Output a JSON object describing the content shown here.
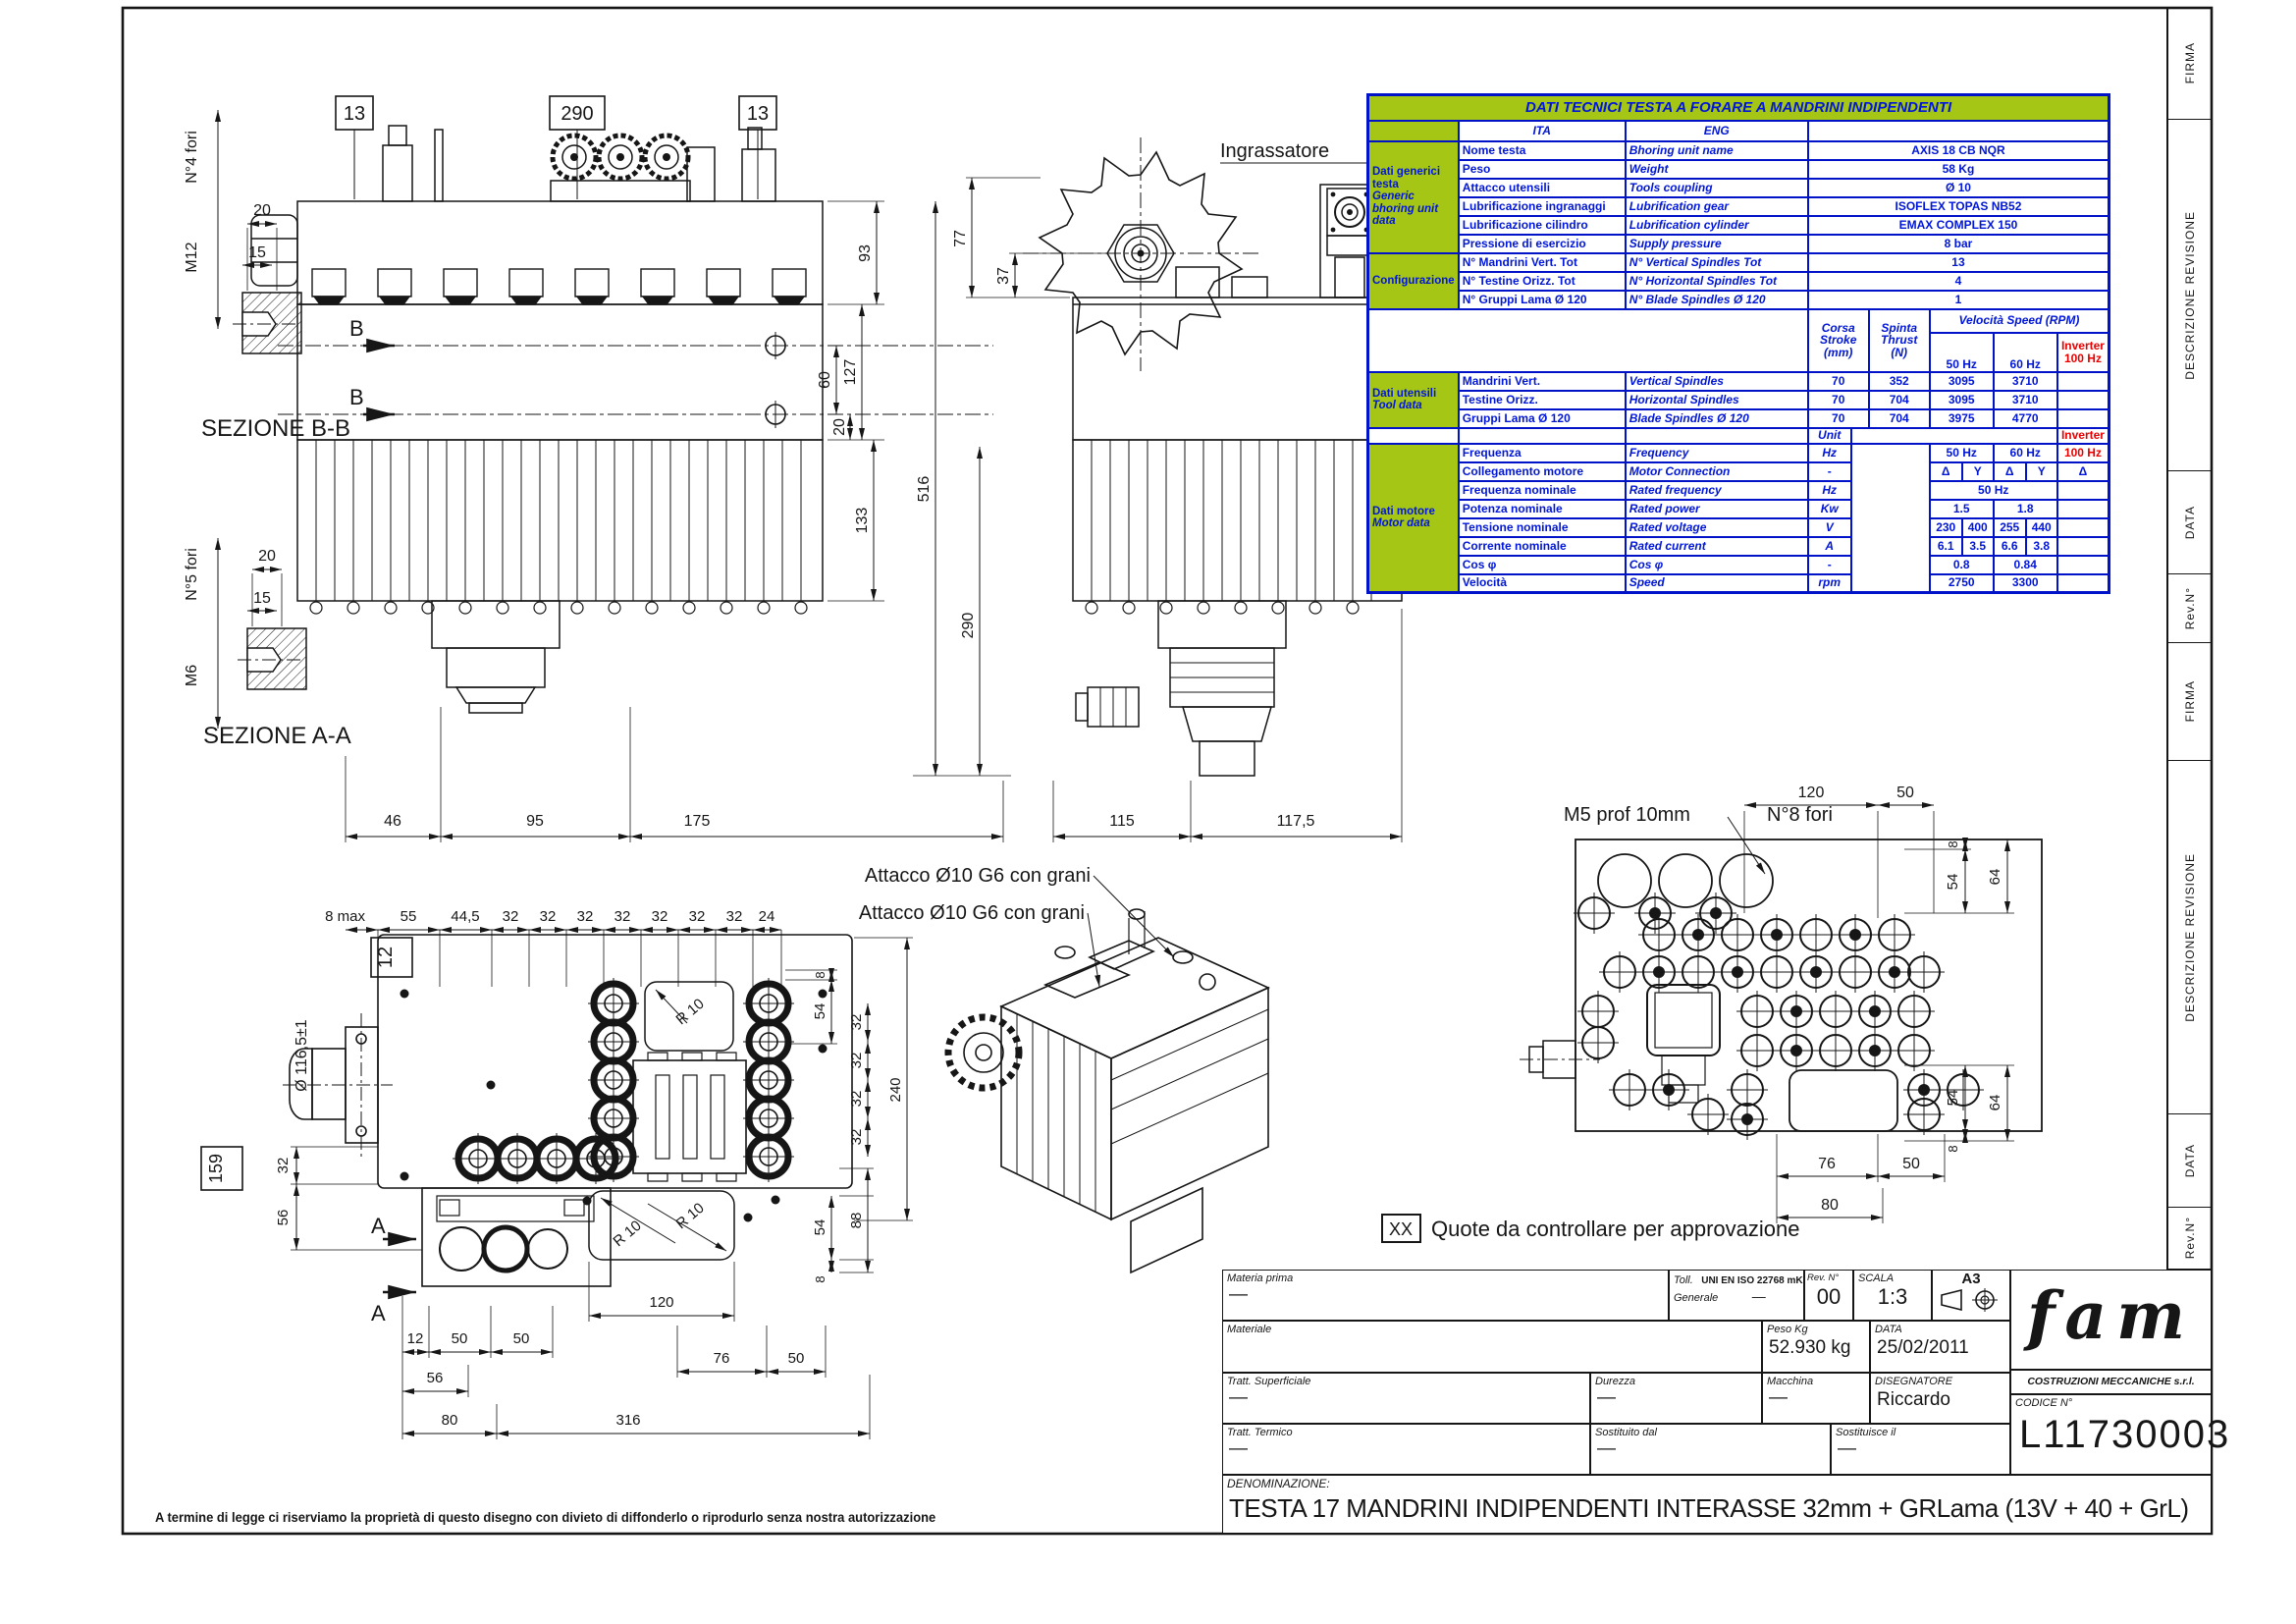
{
  "doc": {
    "legal": "A termine di legge ci riserviamo la proprietà di questo disegno con divieto di diffonderlo o riprodurlo senza nostra autorizzazione",
    "approval_tag": "XX",
    "approval_text": "Quote da controllare per approvazione"
  },
  "revision_strip": {
    "firma": "FIRMA",
    "descrizione": "DESCRIZIONE REVISIONE",
    "data": "DATA",
    "rev": "Rev.N°"
  },
  "table": {
    "title": "DATI TECNICI TESTA A FORARE A MANDRINI INDIPENDENTI",
    "ita": "ITA",
    "eng": "ENG",
    "generic_cat": [
      "Dati generici",
      "testa",
      "Generic",
      "bhoring unit",
      "data"
    ],
    "config_cat": "Configurazione",
    "tool_cat": [
      "Dati utensili",
      "Tool data"
    ],
    "motor_cat": [
      "Dati motore",
      "Motor data"
    ],
    "generic_rows": [
      {
        "ita": "Nome testa",
        "eng": "Bhoring unit name",
        "val": "AXIS 18 CB NQR"
      },
      {
        "ita": "Peso",
        "eng": "Weight",
        "val": "58 Kg"
      },
      {
        "ita": "Attacco utensili",
        "eng": "Tools coupling",
        "val": "Ø 10"
      },
      {
        "ita": "Lubrificazione ingranaggi",
        "eng": "Lubrification gear",
        "val": "ISOFLEX TOPAS NB52"
      },
      {
        "ita": "Lubrificazione cilindro",
        "eng": "Lubrification cylinder",
        "val": "EMAX COMPLEX 150"
      },
      {
        "ita": "Pressione di esercizio",
        "eng": "Supply pressure",
        "val": "8 bar"
      }
    ],
    "config_rows": [
      {
        "ita": "N° Mandrini Vert. Tot",
        "eng": "N° Vertical Spindles Tot",
        "val": "13"
      },
      {
        "ita": "N° Testine Orizz. Tot",
        "eng": "N° Horizontal Spindles Tot",
        "val": "4"
      },
      {
        "ita": "N° Gruppi Lama Ø 120",
        "eng": "N° Blade Spindles Ø 120",
        "val": "1"
      }
    ],
    "speed_head": {
      "corsa": [
        "Corsa",
        "Stroke",
        "(mm)"
      ],
      "spinta": [
        "Spinta",
        "Thrust",
        "(N)"
      ],
      "vel": "Velocità Speed   (RPM)",
      "hz50": "50 Hz",
      "hz60": "60 Hz",
      "inverter": "Inverter",
      "hz100": "100 Hz"
    },
    "tool_rows": [
      {
        "ita": "Mandrini Vert.",
        "eng": "Vertical Spindles",
        "corsa": "70",
        "spinta": "352",
        "v50": "3095",
        "v60": "3710"
      },
      {
        "ita": "Testine Orizz.",
        "eng": "Horizontal Spindles",
        "corsa": "70",
        "spinta": "704",
        "v50": "3095",
        "v60": "3710"
      },
      {
        "ita": "Gruppi Lama Ø 120",
        "eng": "Blade Spindles Ø 120",
        "corsa": "70",
        "spinta": "704",
        "v50": "3975",
        "v60": "4770"
      }
    ],
    "unit_label": "Unit",
    "inverter_label": "Inverter",
    "motor_rows": {
      "freq": {
        "ita": "Frequenza",
        "eng": "Frequency",
        "unit": "Hz",
        "h50": "50 Hz",
        "h60": "60 Hz",
        "h100": "100 Hz"
      },
      "conn": {
        "ita": "Collegamento motore",
        "eng": "Motor Connection",
        "unit": "-",
        "c1": "Δ",
        "c2": "Y",
        "c3": "Δ",
        "c4": "Y",
        "c5": "Δ"
      },
      "rfreq": {
        "ita": "Frequenza nominale",
        "eng": "Rated frequency",
        "unit": "Hz",
        "val": "50 Hz"
      },
      "power": {
        "ita": "Potenza nominale",
        "eng": "Rated power",
        "unit": "Kw",
        "v50": "1.5",
        "v60": "1.8"
      },
      "volt": {
        "ita": "Tensione nominale",
        "eng": "Rated voltage",
        "unit": "V",
        "v1": "230",
        "v2": "400",
        "v3": "255",
        "v4": "440"
      },
      "curr": {
        "ita": "Corrente nominale",
        "eng": "Rated current",
        "unit": "A",
        "v1": "6.1",
        "v2": "3.5",
        "v3": "6.6",
        "v4": "3.8"
      },
      "cos": {
        "ita": "Cos φ",
        "eng": "Cos φ",
        "unit": "-",
        "v50": "0.8",
        "v60": "0.84"
      },
      "speed": {
        "ita": "Velocità",
        "eng": "Speed",
        "unit": "rpm",
        "v50": "2750",
        "v60": "3300"
      }
    }
  },
  "tblock": {
    "materia_prima_label": "Materia prima",
    "materia_prima": "—",
    "toll_label": "Toll.",
    "toll_label2": "Generale",
    "toll_val": "UNI EN ISO 22768 mK",
    "toll_val2": "—",
    "rev_label": "Rev. N°",
    "rev": "00",
    "scala_label": "SCALA",
    "scala": "1:3",
    "format": "A3",
    "materiale_label": "Materiale",
    "materiale": "",
    "peso_label": "Peso Kg",
    "peso": "52.930 kg",
    "data_label": "DATA",
    "data": "25/02/2011",
    "tratt_sup_label": "Tratt. Superficiale",
    "tratt_sup": "—",
    "durezza_label": "Durezza",
    "durezza": "—",
    "macchina_label": "Macchina",
    "macchina": "—",
    "disegnatore_label": "DISEGNATORE",
    "disegnatore": "Riccardo",
    "tratt_term_label": "Tratt. Termico",
    "tratt_term": "—",
    "sost_dal_label": "Sostituito dal",
    "sost_dal": "—",
    "sost_il_label": "Sostituisce il",
    "sost_il": "—",
    "logo": "fam",
    "company": "COSTRUZIONI MECCANICHE s.r.l. PESARO",
    "codice_label": "CODICE N°",
    "codice": "L11730003",
    "denom_label": "DENOMINAZIONE:",
    "denom": "TESTA 17 MANDRINI INDIPENDENTI INTERASSE 32mm + GRLama (13V + 40 + GrL)"
  },
  "views": {
    "front": {
      "b13l": "13",
      "b290": "290",
      "b13r": "13",
      "bmark": "B",
      "d93": "93",
      "d127": "127",
      "d60": "60",
      "d20": "20",
      "d133": "133",
      "d46": "46",
      "d95": "95",
      "d175": "175",
      "d516": "516",
      "d290v": "290"
    },
    "side": {
      "greaser": "Ingrassatore",
      "d77": "77",
      "d37": "37",
      "d115": "115",
      "d1175": "117,5"
    },
    "sez_bb": {
      "title": "SEZIONE B-B",
      "thread": "M12",
      "fori": "N°4 fori",
      "d20": "20",
      "d15": "15"
    },
    "sez_aa": {
      "title": "SEZIONE A-A",
      "thread": "M6",
      "fori": "N°5 fori",
      "d20": "20",
      "d15": "15"
    },
    "bottom": {
      "d8max": "8 max",
      "chain": [
        "55",
        "44,5",
        "32",
        "32",
        "32",
        "32",
        "32",
        "32",
        "32",
        "24"
      ],
      "b12": "12",
      "dia": "Ø 116,5±1",
      "b159": "159",
      "d32": "32",
      "d56": "56",
      "amark": "A",
      "d12": "12",
      "d50a": "50",
      "d50b": "50",
      "d56b": "56",
      "d80": "80",
      "d316": "316",
      "d120": "120",
      "d76": "76",
      "d50c": "50",
      "r10": "R 10",
      "r8": "8",
      "r54": "54",
      "rchain": [
        "32",
        "32",
        "32",
        "32"
      ],
      "r240": "240",
      "r88": "88",
      "r54b": "54",
      "r8b": "8"
    },
    "iso": {
      "label1": "Attacco Ø10 G6 con grani",
      "label2": "Attacco Ø10 G6 con grani"
    },
    "top": {
      "label_m5": "M5 prof 10mm",
      "label_fori": "N°8 fori",
      "d120": "120",
      "d50": "50",
      "d8t": "8",
      "d54t": "54",
      "d64t": "64",
      "d54b": "54",
      "d64b": "64",
      "d8b": "8",
      "d76": "76",
      "d50b": "50",
      "d80": "80"
    }
  }
}
